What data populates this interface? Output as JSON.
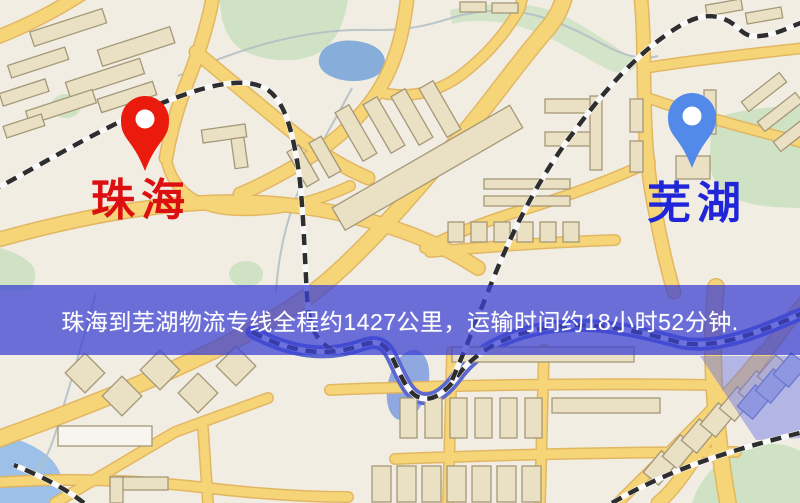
{
  "banner": {
    "text": "珠海到芜湖物流专线全程约1427公里，运输时间约18小时52分钟."
  },
  "route": {
    "origin": "珠海",
    "destination": "芜湖",
    "distance_km": "1427",
    "duration": "18小时52分钟"
  },
  "markers": {
    "origin": {
      "label": "珠海",
      "pin_color": "#ea1a0d",
      "label_color": "#dc1010"
    },
    "destination": {
      "label": "芜湖",
      "pin_color": "#5389e8",
      "label_color": "#2026d8"
    }
  },
  "colors": {
    "map_background": "#f1ede3",
    "road": "#f6d478",
    "road_casing": "#e0b45c",
    "building": "#eae0c4",
    "park": "#cfe2c4",
    "lake": "#87aeda",
    "river": "#5a68cf",
    "railway": "#2e2e2e",
    "banner_background": "rgba(60,65,210,0.74)",
    "banner_text": "#ffffff"
  }
}
